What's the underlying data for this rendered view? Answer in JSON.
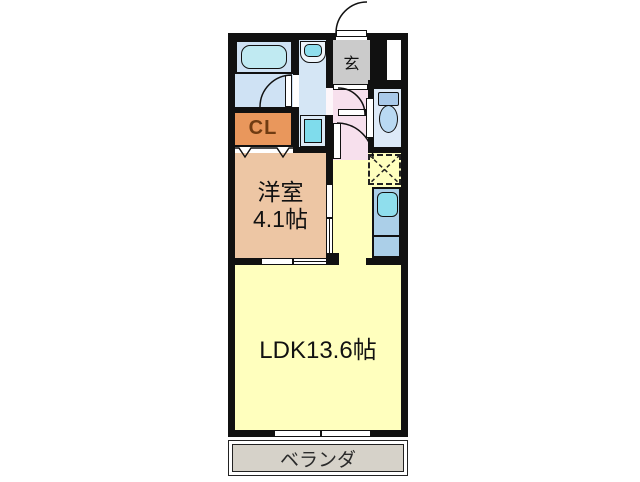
{
  "rooms": {
    "genkan": {
      "label": "玄"
    },
    "closet": {
      "label": "CL"
    },
    "western_room": {
      "label": "洋室",
      "size": "4.1帖"
    },
    "ldk": {
      "label": "LDK13.6帖"
    },
    "veranda": {
      "label": "ベランダ"
    }
  },
  "fixtures": {
    "bathtub": "rounded-rect",
    "washbasin": "rounded-bowl",
    "washing_machine_space": "nested-squares",
    "toilet": "tank-and-bowl",
    "kitchen_sink": "rounded-rect",
    "refrigerator_space": "dashed-box-with-cross"
  },
  "colors": {
    "wall": "#111111",
    "ldk": "#ffffbe",
    "western": "#edc6a4",
    "closet": "#e9975c",
    "closet_text": "#6f3b12",
    "genkan": "#cbcbcb",
    "hall": "#f7e0ed",
    "bathroom": "#cfe2f4",
    "washroom": "#d5e6f5",
    "toilet_room": "#ddeaf8",
    "counter": "#abcfe8",
    "fixture_cyan": "#8fdeed",
    "tub": "#c0eaf2",
    "veranda": "#d6d2c9"
  }
}
